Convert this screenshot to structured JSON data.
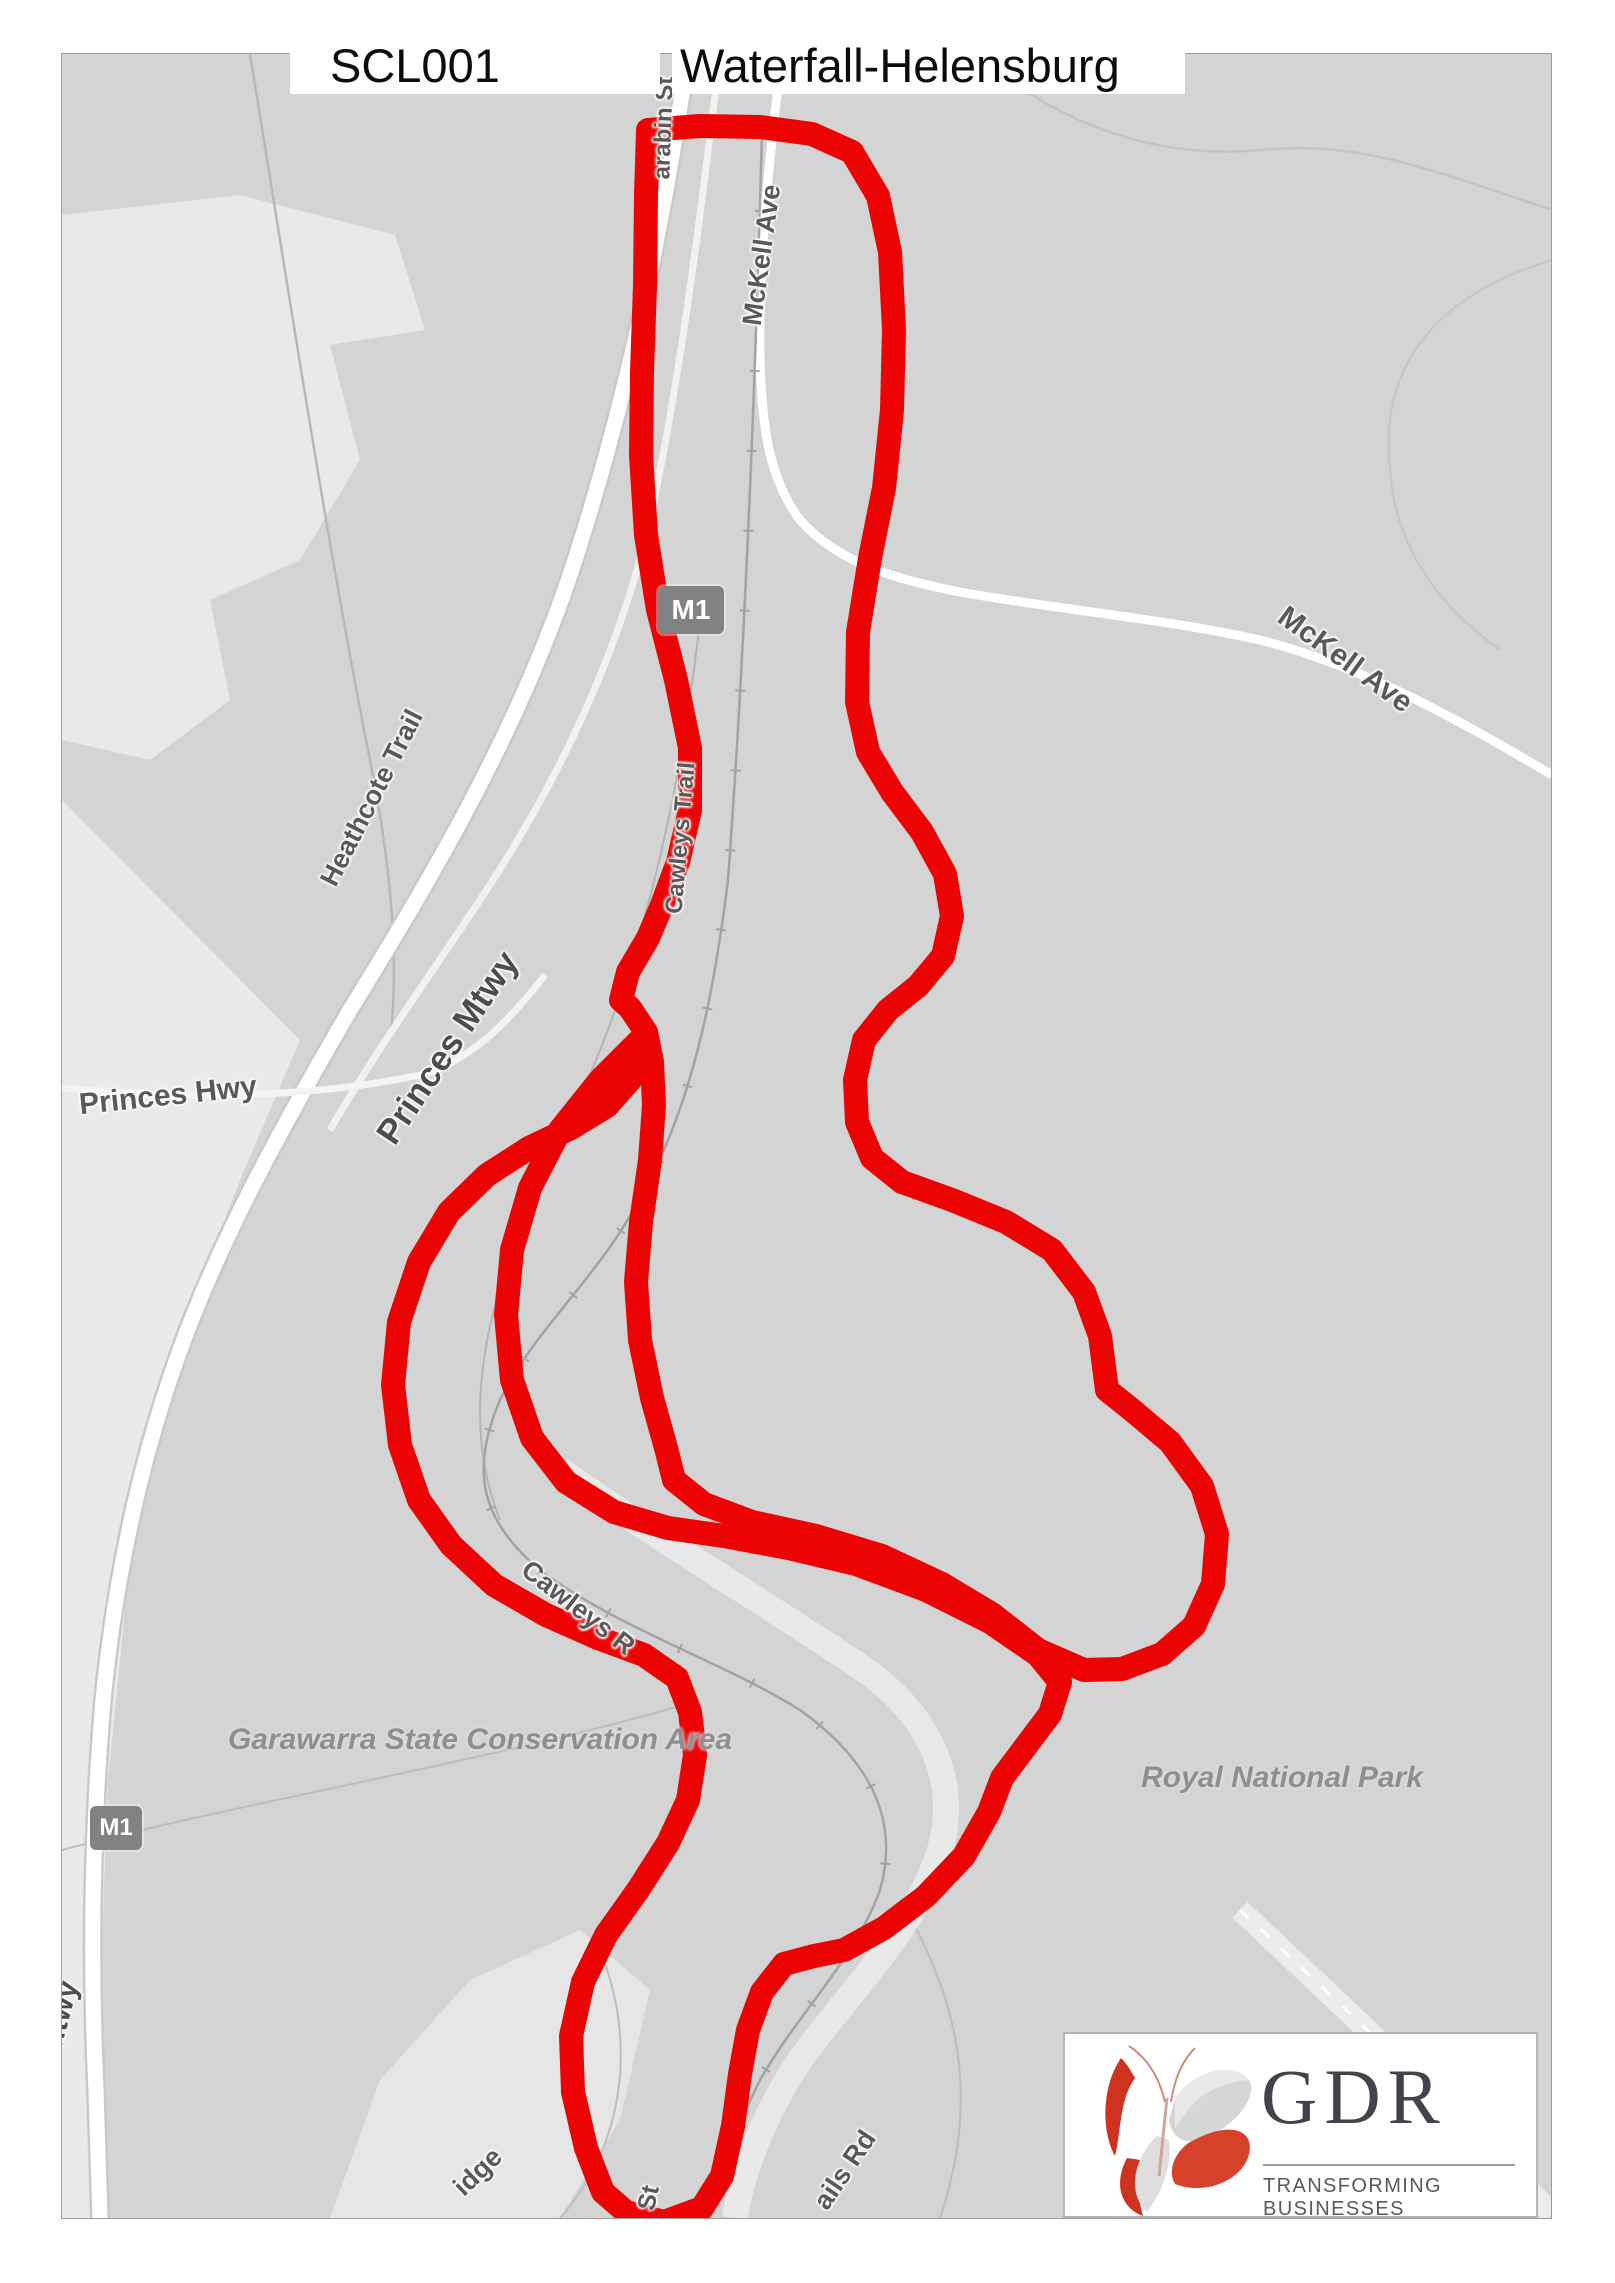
{
  "title": {
    "route_id": "SCL001",
    "route_name": "Waterfall-Helensburg"
  },
  "map": {
    "accent_color": "#ec0404",
    "base_color": "#d4d4d4",
    "road_shields": [
      {
        "label": "M1"
      },
      {
        "label": "M1"
      }
    ],
    "labels": {
      "mckell_ave_north": "McKell Ave",
      "mckell_ave_east": "McKell Ave",
      "heathcote_trail": "Heathcote Trail",
      "princes_mtwy": "Princes Mtwy",
      "princes_hwy": "Princes Hwy",
      "cawleys_trail": "Cawleys Trail",
      "cawleys_rd_partial": "Cawleys R",
      "garawarra": "Garawarra State Conservation Area",
      "royal_national_park": "Royal National Park",
      "ridge_partial": "idge",
      "st_partial": "St",
      "falls_rd_partial": "ails Rd",
      "mtwy_partial": "Mtwy",
      "warabin_partial": "arabin St"
    }
  },
  "logo": {
    "name": "GDR",
    "tagline": "TRANSFORMING BUSINESSES"
  }
}
